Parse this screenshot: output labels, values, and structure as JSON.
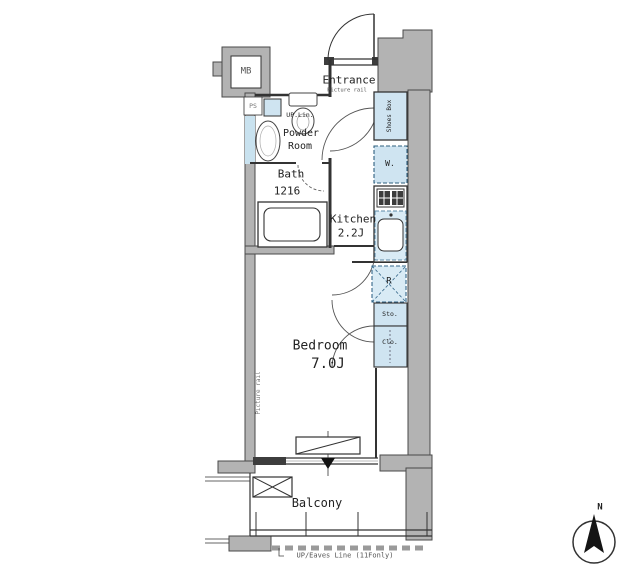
{
  "colors": {
    "wall_gray": "#b3b3b3",
    "fixture_blue": "#cfe4f1",
    "line": "#333333"
  },
  "rooms": {
    "entrance": {
      "label": "Entrance",
      "note": "Picture rail"
    },
    "powder_room": {
      "label_line1": "Powder",
      "label_line2": "Room",
      "note": "UP.Lin."
    },
    "bath": {
      "label": "Bath",
      "size": "1216"
    },
    "kitchen": {
      "label": "Kitchen",
      "size": "2.2J"
    },
    "bedroom": {
      "label": "Bedroom",
      "size": "7.0J",
      "note": "Picture rail"
    },
    "balcony": {
      "label": "Balcony"
    }
  },
  "fixtures": {
    "meter_box": "MB",
    "pipe_space": "PS",
    "shoes_box": "Shoes Box",
    "washer": "W.",
    "refrigerator": "R",
    "storage": "Sto.",
    "closet": "Clo."
  },
  "annotations": {
    "eaves": "UP/Eaves Line (11Fonly)",
    "compass_north": "N"
  }
}
